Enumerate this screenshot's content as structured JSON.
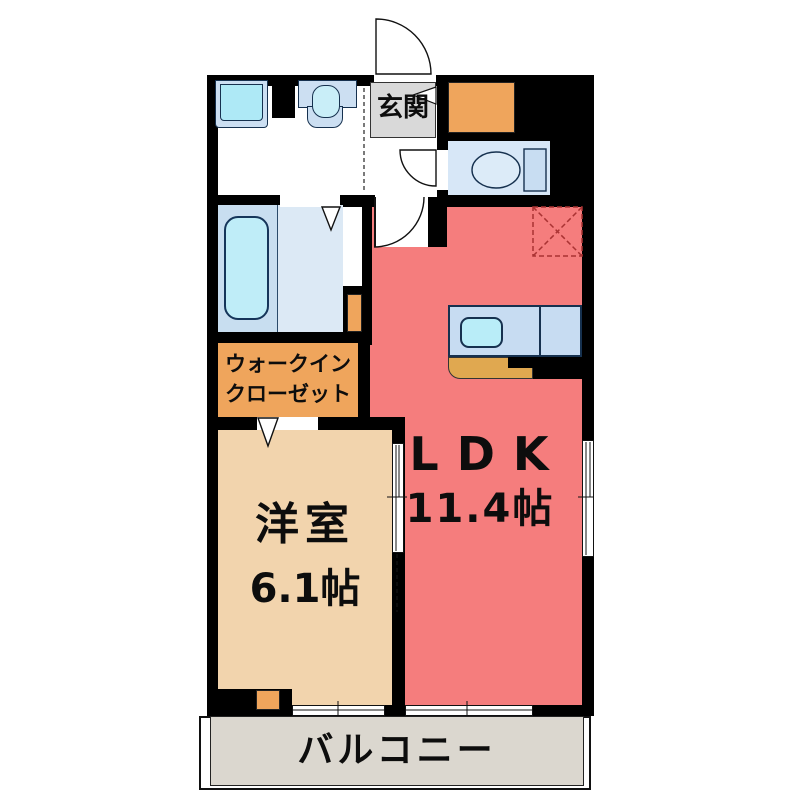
{
  "plan": {
    "entrance": {
      "label": "玄関"
    },
    "ldk": {
      "label": "LDK",
      "size": "11.4帖"
    },
    "western_room": {
      "label": "洋室",
      "size": "6.1帖"
    },
    "walk_in_closet": {
      "line1": "ウォークイン",
      "line2": "クローゼット"
    },
    "balcony": {
      "label": "バルコニー"
    },
    "colors": {
      "wall": "#000000",
      "ldk_red": "#f57d7d",
      "room_beige": "#f2d4ad",
      "closet_orange": "#efa55c",
      "kitchen_tan": "#e0a850",
      "balcony_gray": "#dbd7cf",
      "entry_gray": "#d9d9d9",
      "fixture_blue": "#ccdff2",
      "fixture_cyan": "#aee9f6",
      "bathroom_blue": "#c8def0",
      "bathroom_blue_light": "#dce9f5",
      "toilet_room_blue": "#d7e7f7",
      "counter_blue": "#c7dcf2",
      "fridge_dash": "#aa3333"
    },
    "fixtures": [
      "washing-machine-pan",
      "vanity-sink",
      "bathtub",
      "toilet",
      "kitchen-sink",
      "kitchen-counter",
      "refrigerator-space",
      "shoe-cabinet"
    ]
  }
}
